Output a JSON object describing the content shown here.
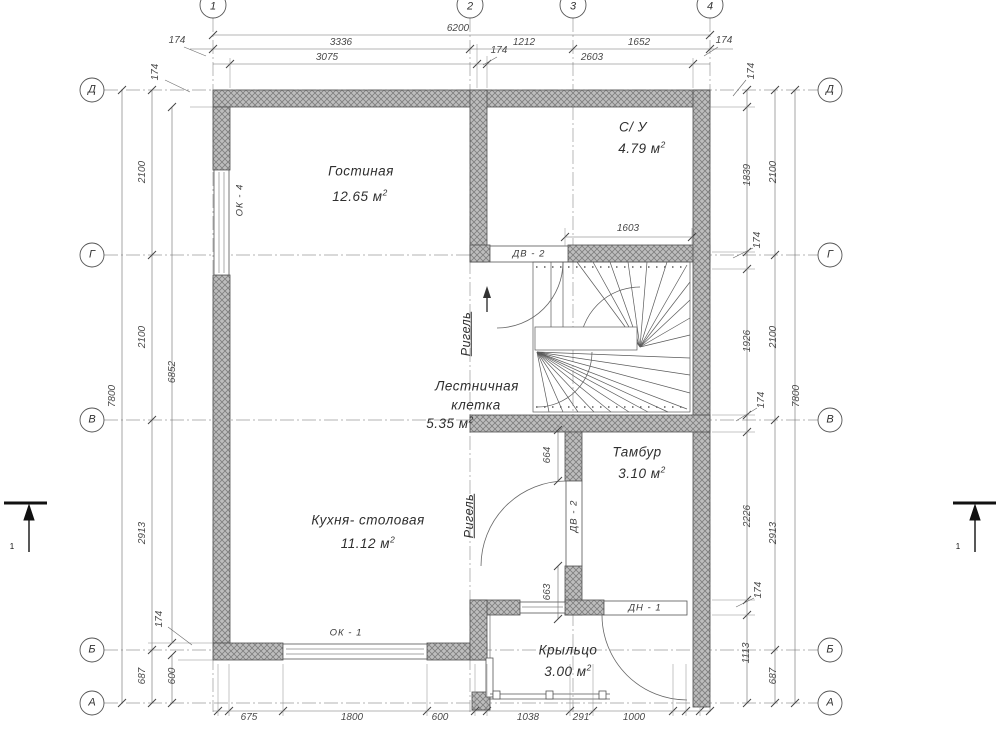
{
  "axes": {
    "columns": [
      "1",
      "2",
      "3",
      "4"
    ],
    "rows": [
      "Д",
      "Г",
      "В",
      "Б",
      "А"
    ]
  },
  "rooms": [
    {
      "name": "Гостиная",
      "area": "12.65  м",
      "sup": "2"
    },
    {
      "name": "С/ У",
      "area": "4.79  м",
      "sup": "2"
    },
    {
      "line1": "Лестничная",
      "line2": "клетка",
      "area": "5.35  м",
      "sup": "2"
    },
    {
      "name": "Кухня- столовая",
      "area": "11.12  м",
      "sup": "2"
    },
    {
      "name": "Тамбур",
      "area": "3.10  м",
      "sup": "2"
    },
    {
      "name": "Крыльцо",
      "area": "3.00  м",
      "sup": "2"
    }
  ],
  "dims": {
    "d6200": "6200",
    "d3336": "3336",
    "d1212": "1212",
    "d1652": "1652",
    "d3075": "3075",
    "d2603": "2603",
    "d7800": "7800",
    "d2100": "2100",
    "d2913": "2913",
    "d687": "687",
    "d6852": "6852",
    "d600": "600",
    "d1839": "1839",
    "d1926": "1926",
    "d2226": "2226",
    "d1113": "1113",
    "d675": "675",
    "d1800": "1800",
    "d1038": "1038",
    "d291": "291",
    "d1000": "1000",
    "d1603": "1603",
    "d664": "664",
    "d663": "663",
    "d174": "174"
  },
  "openings": {
    "ok1": "ОК - 1",
    "ok4": "ОК - 4",
    "dv2": "ДВ - 2",
    "dn1": "ДН - 1"
  },
  "beam": {
    "label": "Ригель"
  },
  "section": {
    "label": "1"
  }
}
